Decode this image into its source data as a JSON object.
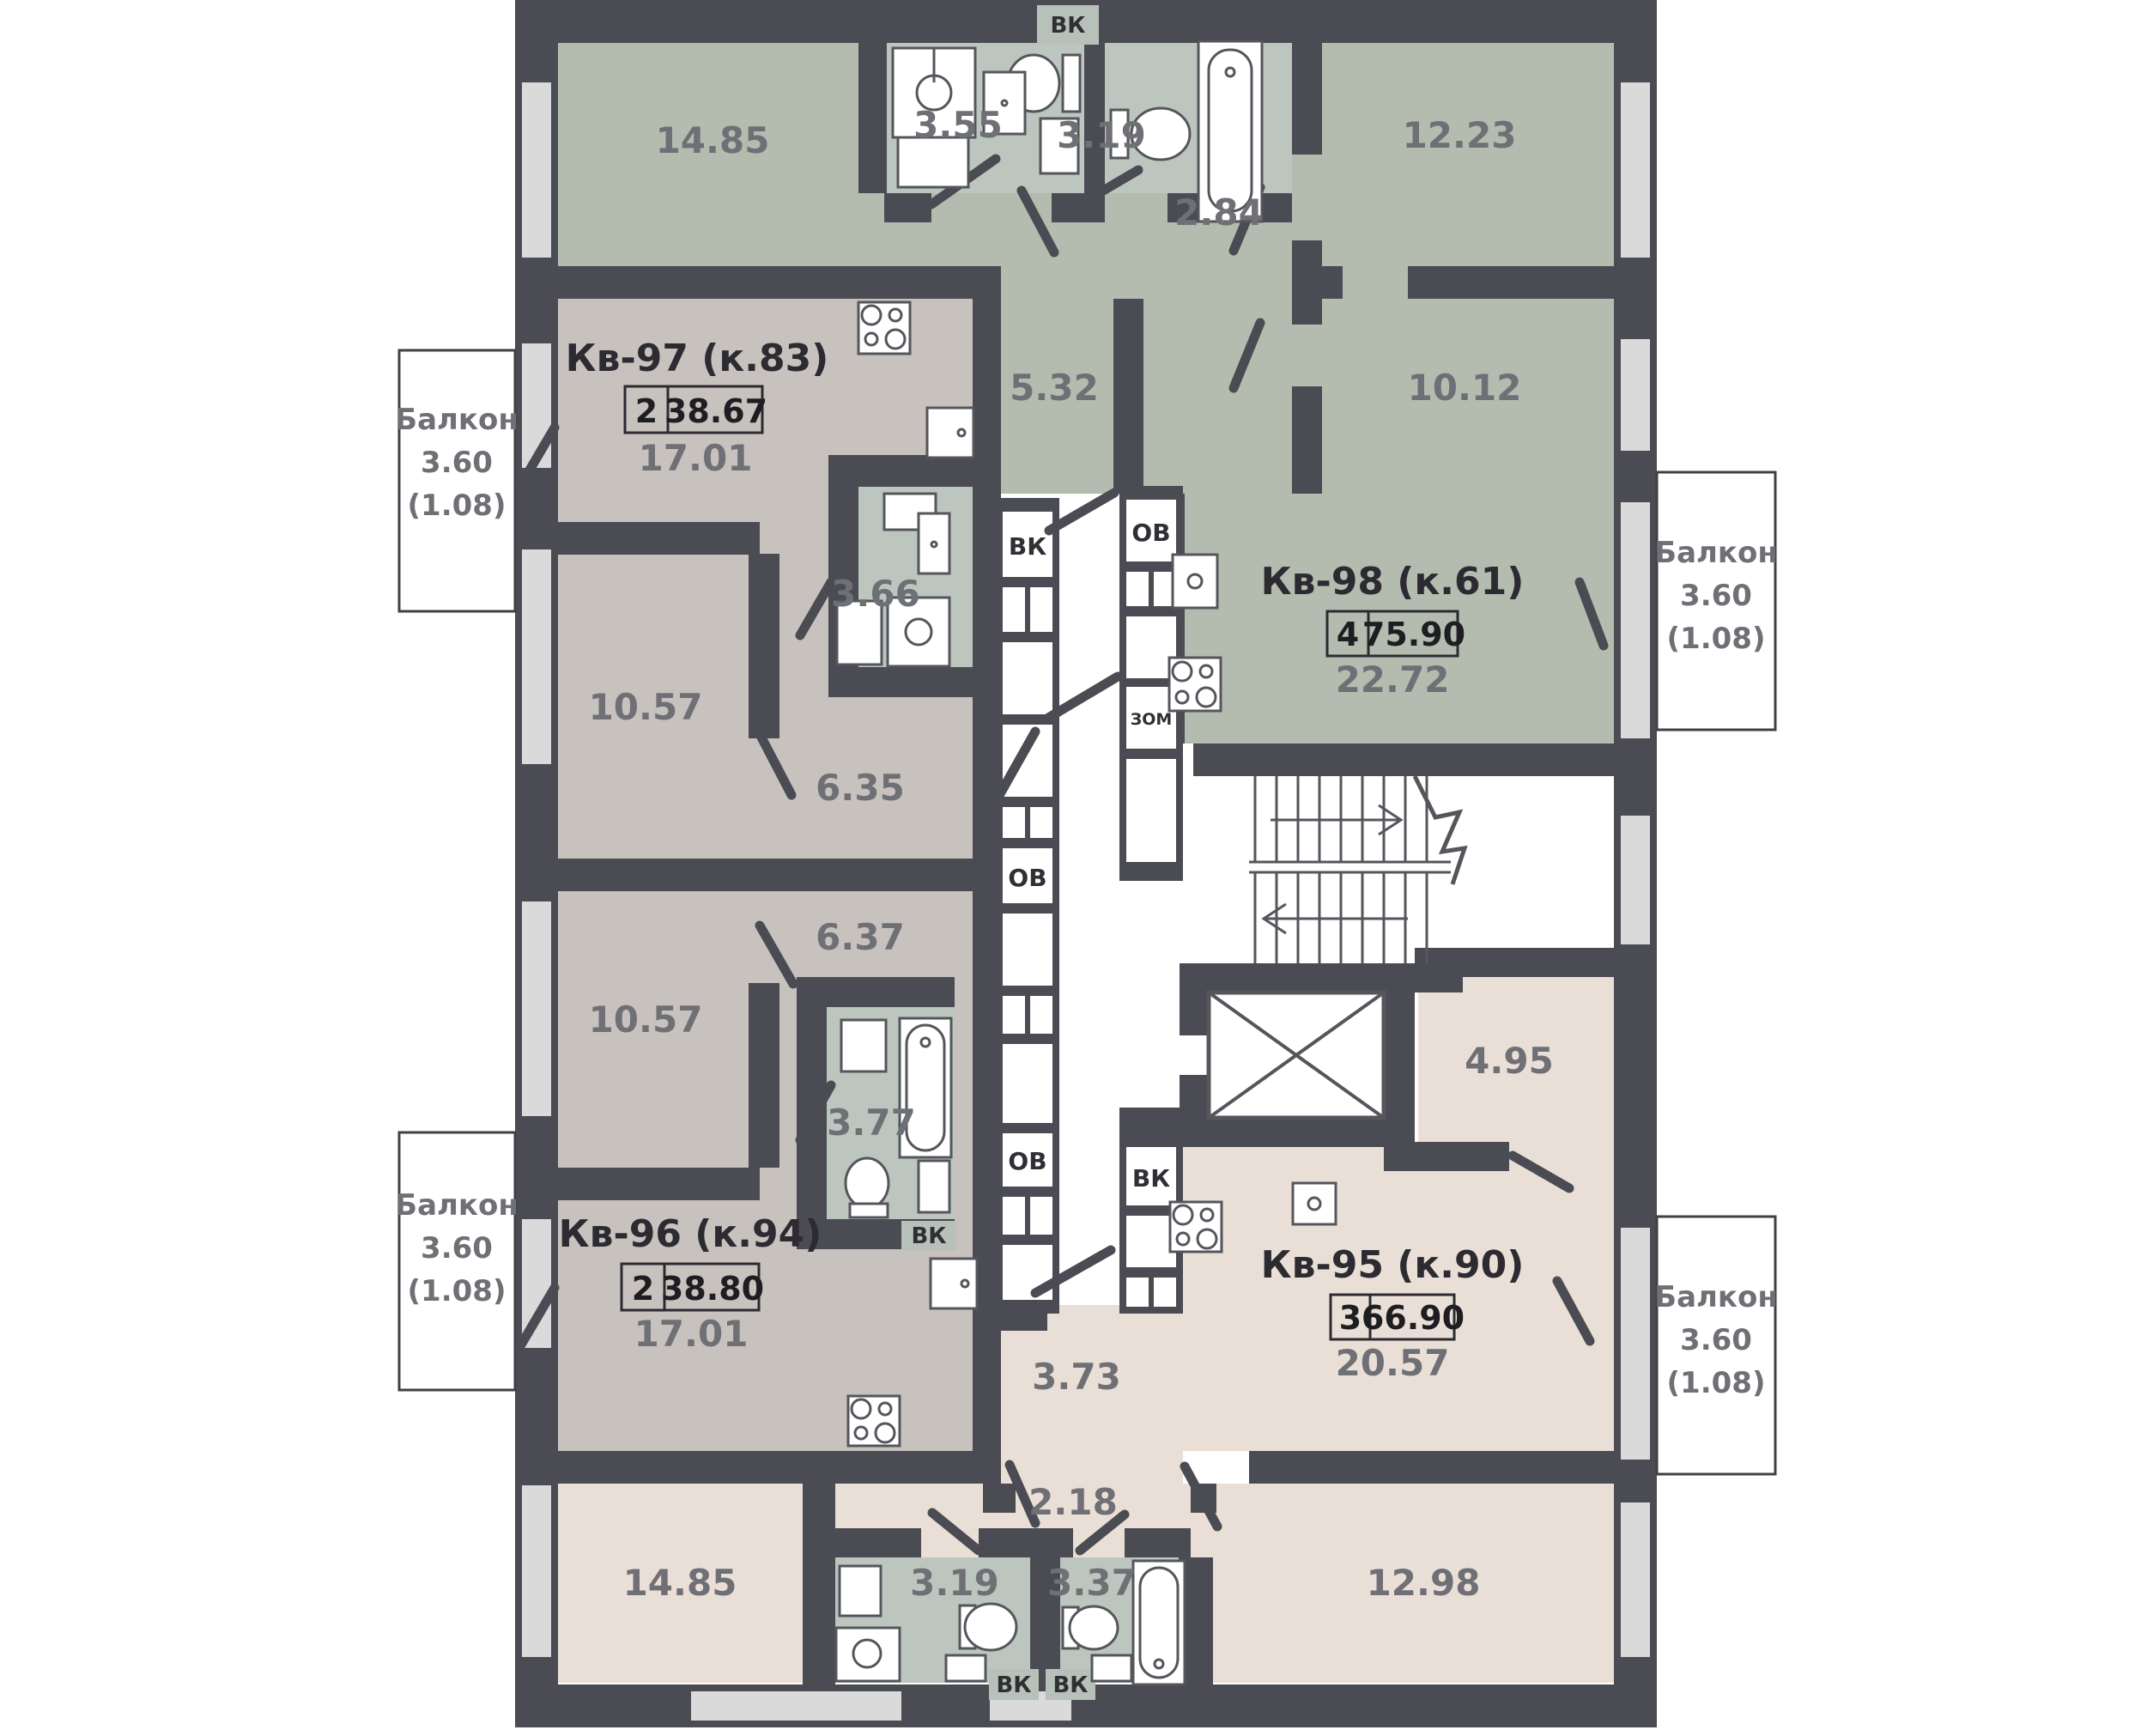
{
  "floor_plan": {
    "apartments": [
      {
        "name": "Кв-97 (к.83)",
        "rooms": "2",
        "total_area": "38.67",
        "main_area": "17.01",
        "areas": {
          "room1": "10.57",
          "hall": "6.35",
          "bathroom": "3.66"
        }
      },
      {
        "name": "Кв-98 (к.61)",
        "rooms": "4",
        "total_area": "75.90",
        "main_area": "22.72",
        "areas": {
          "room1": "14.85",
          "room2": "12.23",
          "room3": "10.12",
          "hall1": "2.84",
          "hall2": "5.32",
          "bathroom1": "3.55",
          "bathroom2": "3.19"
        }
      },
      {
        "name": "Кв-96 (к.94)",
        "rooms": "2",
        "total_area": "38.80",
        "main_area": "17.01",
        "areas": {
          "room1": "10.57",
          "hall": "6.37",
          "bathroom": "3.77"
        }
      },
      {
        "name": "Кв-95 (к.90)",
        "rooms": "3",
        "total_area": "66.90",
        "main_area": "20.57",
        "areas": {
          "room1": "14.85",
          "room2": "12.98",
          "room3": "4.95",
          "hall1": "3.73",
          "hall2": "2.18",
          "bathroom1": "3.19",
          "bathroom2": "3.37"
        }
      }
    ],
    "balcony": {
      "label": "Балкон",
      "area": "3.60",
      "coef": "(1.08)"
    },
    "shaft_labels": {
      "vk": "ВК",
      "ov": "ОВ",
      "zom": "ЗОМ"
    },
    "colors": {
      "wall": "#4b4b53",
      "apartment_green": "#b3bcaf",
      "bathroom_green": "#bcc6bf",
      "apartment_taupe": "#c8c2be",
      "apartment_pink": "#eadfd6",
      "window": "#dadada",
      "label_gray": "#6f7075"
    }
  }
}
